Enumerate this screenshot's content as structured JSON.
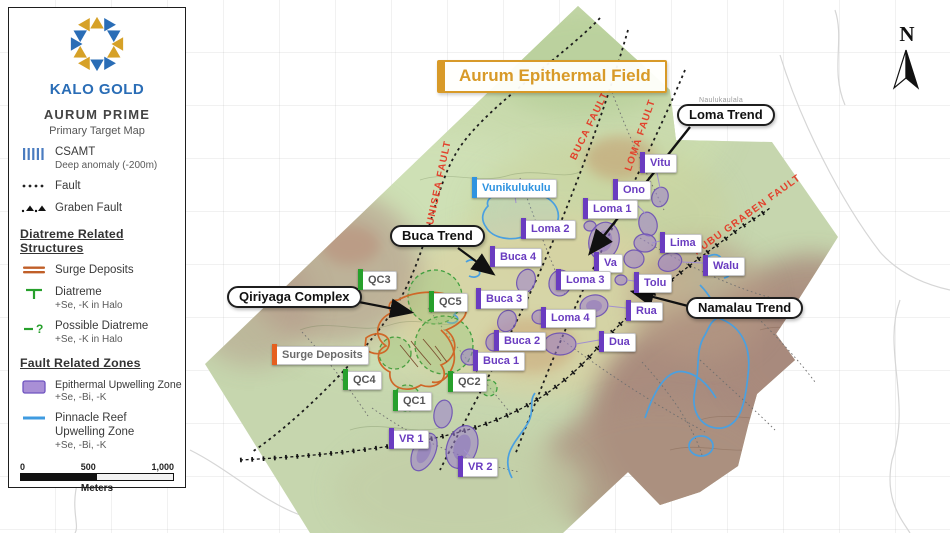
{
  "brand": {
    "name": "KALO GOLD"
  },
  "legend": {
    "title": "AURUM PRIME",
    "subtitle": "Primary Target Map",
    "symbols": [
      {
        "id": "csamt",
        "label": "CSAMT",
        "sublabel": "Deep anomaly (-200m)"
      },
      {
        "id": "fault",
        "label": "Fault",
        "sublabel": ""
      },
      {
        "id": "graben-fault",
        "label": "Graben Fault",
        "sublabel": ""
      }
    ],
    "diatreme_section": {
      "heading": "Diatreme Related Structures",
      "items": [
        {
          "id": "surge-deposits",
          "label": "Surge Deposits",
          "sublabel": ""
        },
        {
          "id": "diatreme",
          "label": "Diatreme",
          "sublabel": "+Se, -K in Halo"
        },
        {
          "id": "possible-diatreme",
          "label": "Possible Diatreme",
          "sublabel": "+Se, -K in Halo"
        }
      ]
    },
    "fault_section": {
      "heading": "Fault Related Zones",
      "items": [
        {
          "id": "epithermal-upwelling-zone",
          "label": "Epithermal Upwelling Zone",
          "sublabel": "+Se, -Bi, -K"
        },
        {
          "id": "pinnacle-reef-upwelling-zone",
          "label": "Pinnacle Reef Upwelling Zone",
          "sublabel": "+Se, -Bi, -K"
        }
      ]
    },
    "scale_bar": {
      "tick0": "0",
      "tick500": "500",
      "tick1000": "1,000",
      "unit": "Meters"
    }
  },
  "map": {
    "title": "Aurum Epithermal Field",
    "north_label": "N",
    "place_label": "Naulukaulala",
    "callouts": [
      {
        "label": "Loma Trend"
      },
      {
        "label": "Buca Trend"
      },
      {
        "label": "Qiriyaga Complex"
      },
      {
        "label": "Namalau Trend"
      }
    ],
    "fault_labels": [
      {
        "label": "VUNISEA FAULT"
      },
      {
        "label": "BUCA FAULT"
      },
      {
        "label": "LOMA FAULT"
      },
      {
        "label": "NUBU GRABEN FAULT"
      }
    ],
    "targets": [
      {
        "label": "Vunikulukulu",
        "type": "blue",
        "x": 472,
        "y": 177
      },
      {
        "label": "Vitu",
        "type": "purple",
        "x": 640,
        "y": 152
      },
      {
        "label": "Ono",
        "type": "purple",
        "x": 613,
        "y": 179
      },
      {
        "label": "Loma 1",
        "type": "purple",
        "x": 583,
        "y": 198
      },
      {
        "label": "Loma 2",
        "type": "purple",
        "x": 521,
        "y": 218
      },
      {
        "label": "Lima",
        "type": "purple",
        "x": 660,
        "y": 232
      },
      {
        "label": "Buca 4",
        "type": "purple",
        "x": 490,
        "y": 246
      },
      {
        "label": "Va",
        "type": "purple",
        "x": 594,
        "y": 252
      },
      {
        "label": "Walu",
        "type": "purple",
        "x": 703,
        "y": 255
      },
      {
        "label": "Loma 3",
        "type": "purple",
        "x": 556,
        "y": 269
      },
      {
        "label": "Tolu",
        "type": "purple",
        "x": 634,
        "y": 272
      },
      {
        "label": "Buca 3",
        "type": "purple",
        "x": 476,
        "y": 288
      },
      {
        "label": "Rua",
        "type": "purple",
        "x": 626,
        "y": 300
      },
      {
        "label": "Loma 4",
        "type": "purple",
        "x": 541,
        "y": 307
      },
      {
        "label": "Buca 2",
        "type": "purple",
        "x": 494,
        "y": 330
      },
      {
        "label": "Dua",
        "type": "purple",
        "x": 599,
        "y": 331
      },
      {
        "label": "Buca 1",
        "type": "purple",
        "x": 473,
        "y": 350
      },
      {
        "label": "VR 1",
        "type": "purple",
        "x": 389,
        "y": 428
      },
      {
        "label": "VR 2",
        "type": "purple",
        "x": 458,
        "y": 456
      },
      {
        "label": "QC3",
        "type": "green",
        "x": 358,
        "y": 269
      },
      {
        "label": "QC5",
        "type": "green",
        "x": 429,
        "y": 291
      },
      {
        "label": "QC4",
        "type": "green",
        "x": 343,
        "y": 369
      },
      {
        "label": "QC2",
        "type": "green",
        "x": 448,
        "y": 371
      },
      {
        "label": "QC1",
        "type": "green",
        "x": 393,
        "y": 390
      },
      {
        "label": "Surge Deposits",
        "type": "orange",
        "x": 272,
        "y": 344
      }
    ]
  },
  "icons": {
    "question_glyph": "?"
  },
  "colors": {
    "accent_gold": "#d89a28",
    "target_purple": "#6a3cc0",
    "diatreme_green": "#27a02c",
    "surge_orange": "#e55f1f",
    "reef_blue": "#3f9be0",
    "fault_red": "#e2412c",
    "brand_blue": "#2a6db6"
  }
}
